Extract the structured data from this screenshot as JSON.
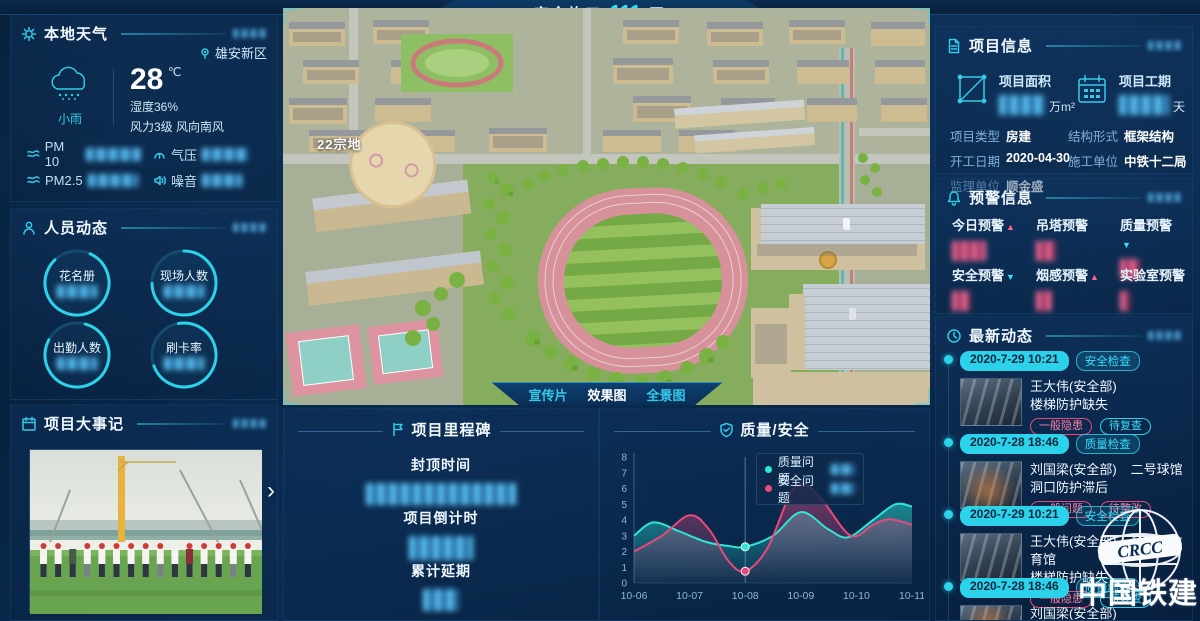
{
  "colors": {
    "accent": "#2bd2e9",
    "pink": "#e8497c",
    "teal": "#2ee6d6",
    "bg": "#0a2c52"
  },
  "banner": {
    "prefix": "安全施工",
    "days": "111",
    "suffix": "天"
  },
  "weather": {
    "title": "本地天气",
    "location": "雄安新区",
    "condition": "小雨",
    "temperature": "28",
    "temp_unit": "℃",
    "humidity": "湿度36%",
    "wind": "风力3级 风向南风",
    "metrics": [
      {
        "label": "PM 10"
      },
      {
        "label": "气压"
      },
      {
        "label": "PM2.5"
      },
      {
        "label": "噪音"
      }
    ]
  },
  "personnel": {
    "title": "人员动态",
    "rings": [
      {
        "label": "花名册"
      },
      {
        "label": "现场人数"
      },
      {
        "label": "出勤人数"
      },
      {
        "label": "刷卡率"
      }
    ]
  },
  "events": {
    "title": "项目大事记",
    "next_arrow": "›"
  },
  "main_view": {
    "site_label": "22宗地",
    "tabs": [
      {
        "label": "宣传片"
      },
      {
        "label": "效果图"
      },
      {
        "label": "全景图"
      }
    ]
  },
  "milestone": {
    "title": "项目里程碑",
    "items": [
      {
        "label": "封顶时间"
      },
      {
        "label": "项目倒计时"
      },
      {
        "label": "累计延期"
      }
    ]
  },
  "project_info": {
    "title": "项目信息",
    "stats": [
      {
        "label": "项目面积",
        "unit": "万m²"
      },
      {
        "label": "项目工期",
        "unit": "天"
      }
    ],
    "fields": [
      {
        "label": "项目类型",
        "value": "房建"
      },
      {
        "label": "结构形式",
        "value": "框架结构"
      },
      {
        "label": "开工日期",
        "value": "2020-04-30"
      },
      {
        "label": "施工单位",
        "value": "中铁十二局"
      },
      {
        "label": "监理单位",
        "value": "顺金盛"
      }
    ]
  },
  "warnings": {
    "title": "预警信息",
    "items": [
      {
        "label": "今日预警",
        "arrow": "▲"
      },
      {
        "label": "吊塔预警",
        "arrow": ""
      },
      {
        "label": "质量预警",
        "arrow": "▼"
      },
      {
        "label": "安全预警",
        "arrow": "▼"
      },
      {
        "label": "烟感预警",
        "arrow": "▲"
      },
      {
        "label": "实验室预警",
        "arrow": ""
      }
    ]
  },
  "updates": {
    "title": "最新动态",
    "entries": [
      {
        "date": "2020-7-29 10:21",
        "category": "安全检查",
        "person": "王大伟(安全部)",
        "location": "",
        "issue": "楼梯防护缺失",
        "tag1": "一般隐患",
        "tag2": "待复查"
      },
      {
        "date": "2020-7-28 18:46",
        "category": "质量检查",
        "person": "刘国梁(安全部)",
        "location": "二号球馆",
        "issue": "洞口防护滞后",
        "tag1": "一般问题",
        "tag2": "待整改"
      },
      {
        "date": "2020-7-29 10:21",
        "category": "安全检查",
        "person": "王大伟(安全部)",
        "location": "多功能体育馆",
        "issue": "楼梯防护缺失",
        "tag1": "一般隐患",
        "tag2": "待复查"
      },
      {
        "date": "2020-7-28 18:46",
        "category": "质量检查",
        "person": "刘国梁(安全部)",
        "location": "",
        "issue": "",
        "tag1": "",
        "tag2": ""
      }
    ]
  },
  "logo": {
    "abbr": "CRCC",
    "text": "中国铁建"
  },
  "chart_data": {
    "type": "line",
    "title": "质量/安全",
    "categories": [
      "10-06",
      "10-07",
      "10-08",
      "10-09",
      "10-10",
      "10-11"
    ],
    "ylim": [
      0,
      8
    ],
    "yticks": [
      0,
      1,
      2,
      3,
      4,
      5,
      6,
      7,
      8
    ],
    "grid": false,
    "legend_position": "tooltip-at-10-08",
    "series": [
      {
        "name": "质量问题",
        "color": "#2ee6d6",
        "values": [
          3.0,
          3.1,
          2.3,
          4.5,
          3.2,
          4.9
        ],
        "samples": [
          [
            0,
            3.0
          ],
          [
            0.35,
            3.85
          ],
          [
            0.8,
            3.3
          ],
          [
            1.3,
            2.6
          ],
          [
            1.7,
            2.35
          ],
          [
            2,
            2.3
          ],
          [
            2.5,
            3.0
          ],
          [
            3,
            4.5
          ],
          [
            3.5,
            3.4
          ],
          [
            3.85,
            2.9
          ],
          [
            4.3,
            4.0
          ],
          [
            4.7,
            5.0
          ],
          [
            5,
            4.85
          ]
        ]
      },
      {
        "name": "安全问题",
        "color": "#e8497c",
        "values": [
          2.0,
          4.3,
          0.75,
          6.2,
          3.1,
          3.7
        ],
        "samples": [
          [
            0,
            2.0
          ],
          [
            0.5,
            3.0
          ],
          [
            1,
            4.3
          ],
          [
            1.35,
            3.4
          ],
          [
            1.7,
            1.4
          ],
          [
            2,
            0.75
          ],
          [
            2.4,
            2.2
          ],
          [
            2.8,
            5.6
          ],
          [
            3.05,
            6.3
          ],
          [
            3.4,
            5.2
          ],
          [
            3.9,
            3.0
          ],
          [
            4.3,
            3.7
          ],
          [
            4.6,
            4.05
          ],
          [
            5,
            3.7
          ]
        ]
      }
    ],
    "highlight": {
      "category": "10-08",
      "index": 2,
      "quality": 2.3,
      "safety": 0.75
    }
  }
}
